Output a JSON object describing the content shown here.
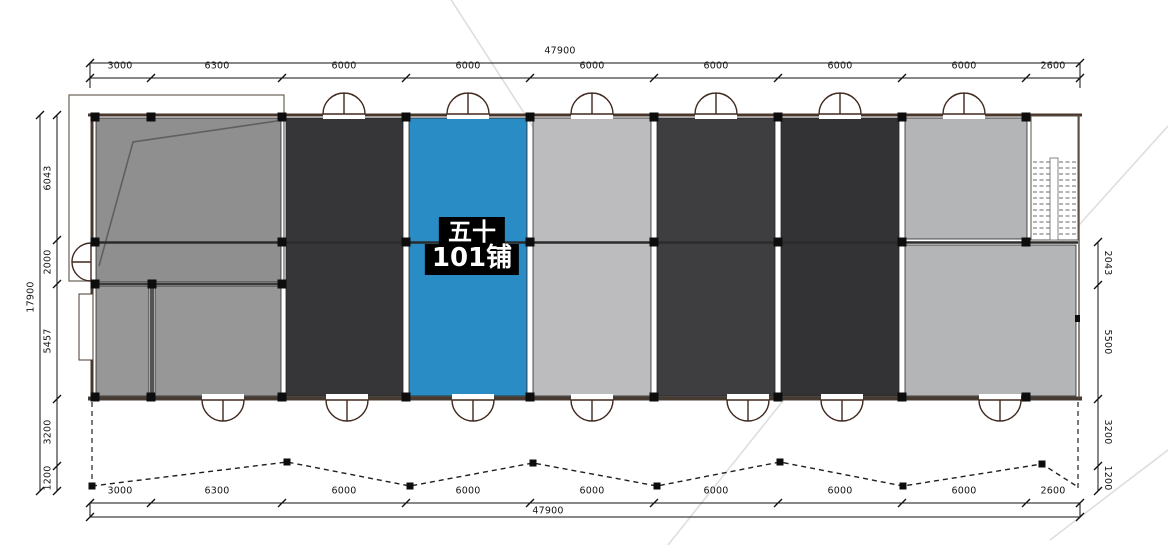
{
  "selected_unit": {
    "name_line1": "五十",
    "name_line2": "101铺"
  },
  "dimensions": {
    "top": {
      "total": "47900",
      "segments": [
        "3000",
        "6300",
        "6000",
        "6000",
        "6000",
        "6000",
        "6000",
        "6000",
        "2600"
      ]
    },
    "bottom": {
      "total": "47900",
      "segments": [
        "3000",
        "6300",
        "6000",
        "6000",
        "6000",
        "6000",
        "6000",
        "6000",
        "2600"
      ]
    },
    "left": {
      "total": "17900",
      "segments": [
        "6043",
        "2000",
        "5457",
        "3200",
        "1200"
      ]
    },
    "right": {
      "segments": [
        "2043",
        "5500",
        "3200",
        "1200"
      ]
    }
  },
  "colors": {
    "unit_highlight": "#2a8cc4",
    "unit_dark": "#363639",
    "unit_dark_2": "#3e3e41",
    "unit_dark_3": "#333336",
    "unit_gray": "#8f8f8f",
    "unit_gray_2": "#979797",
    "unit_light": "#bcbcbe",
    "unit_light_2": "#b4b5b7",
    "label_bg": "#000000",
    "label_text": "#ffffff"
  }
}
